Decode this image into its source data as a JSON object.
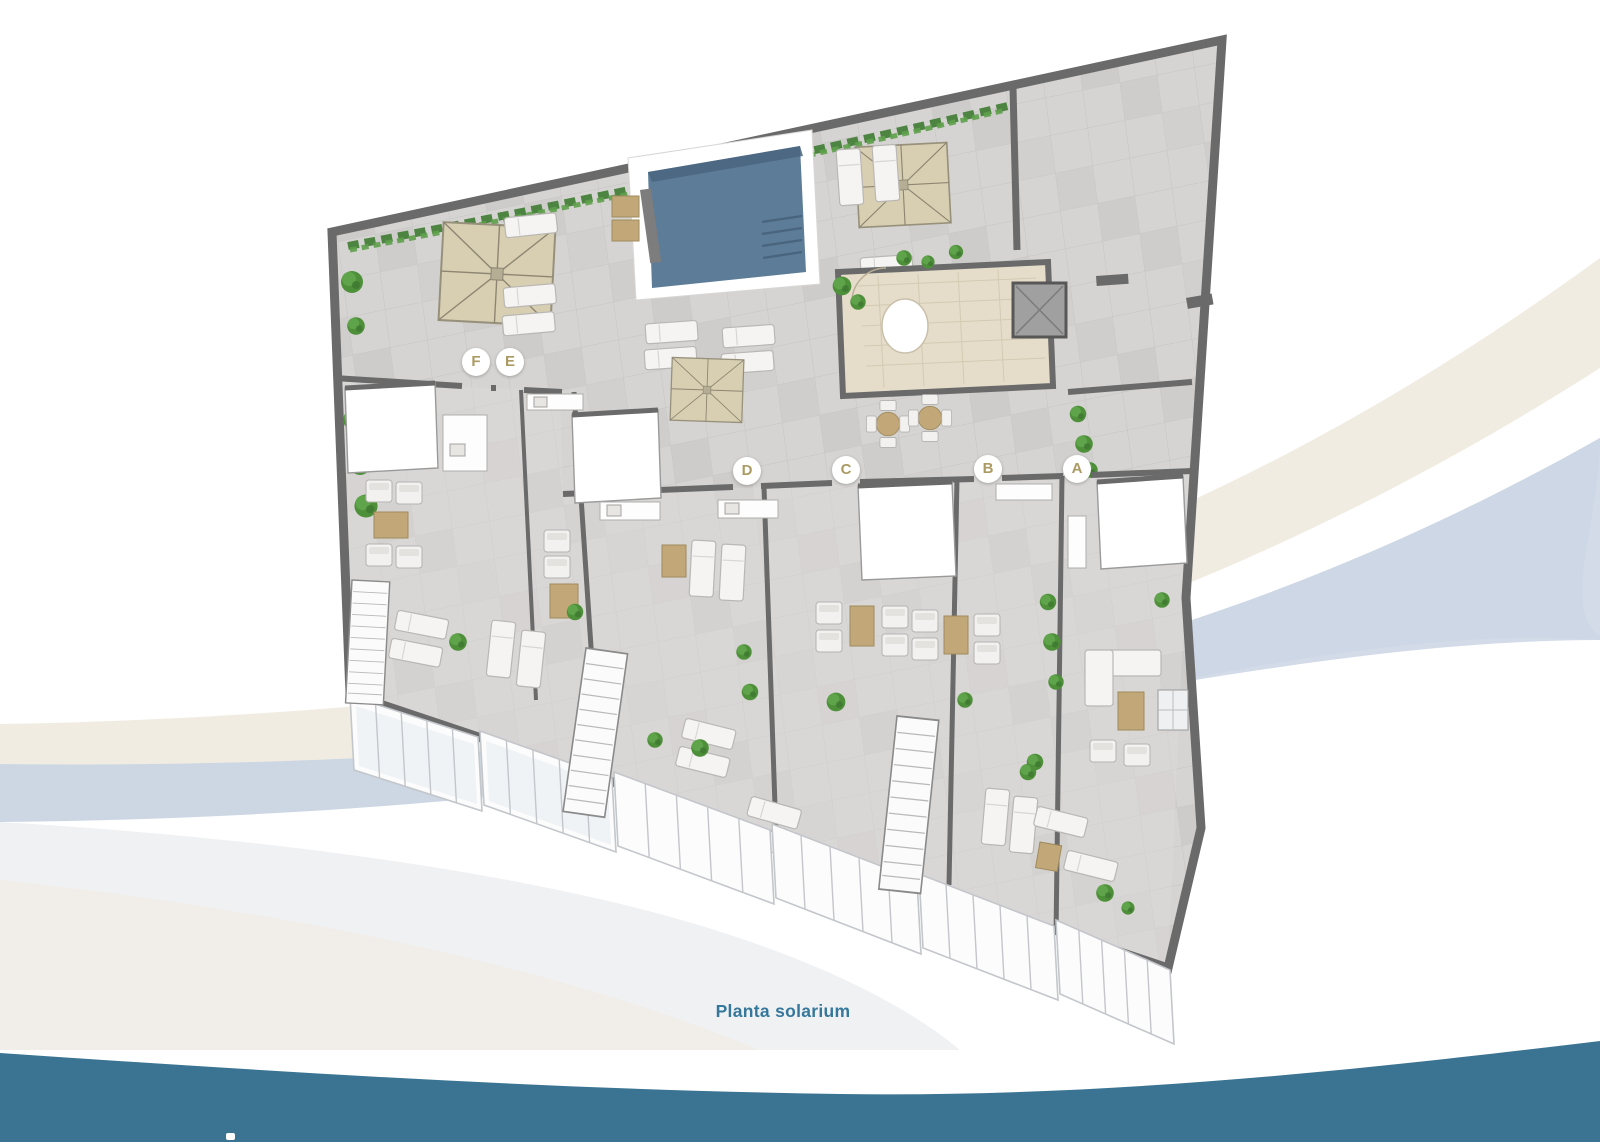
{
  "page": {
    "caption": "Planta solarium"
  },
  "units": [
    {
      "label": "F",
      "x": 476,
      "y": 362
    },
    {
      "label": "E",
      "x": 510,
      "y": 362
    },
    {
      "label": "D",
      "x": 747,
      "y": 471
    },
    {
      "label": "C",
      "x": 846,
      "y": 470
    },
    {
      "label": "B",
      "x": 988,
      "y": 469
    },
    {
      "label": "A",
      "x": 1077,
      "y": 469
    }
  ],
  "colors": {
    "caption": "#35789b",
    "footer_band": "#3a7492",
    "marker_letter": "#ab9a62",
    "pool_water": "#5d7c98",
    "umbrella": "#d8cfb2",
    "wood": "#c2a878",
    "plant": "#4e8f3a",
    "swoosh_cream": "#f1ece2",
    "swoosh_blue": "#cdd7e4"
  }
}
